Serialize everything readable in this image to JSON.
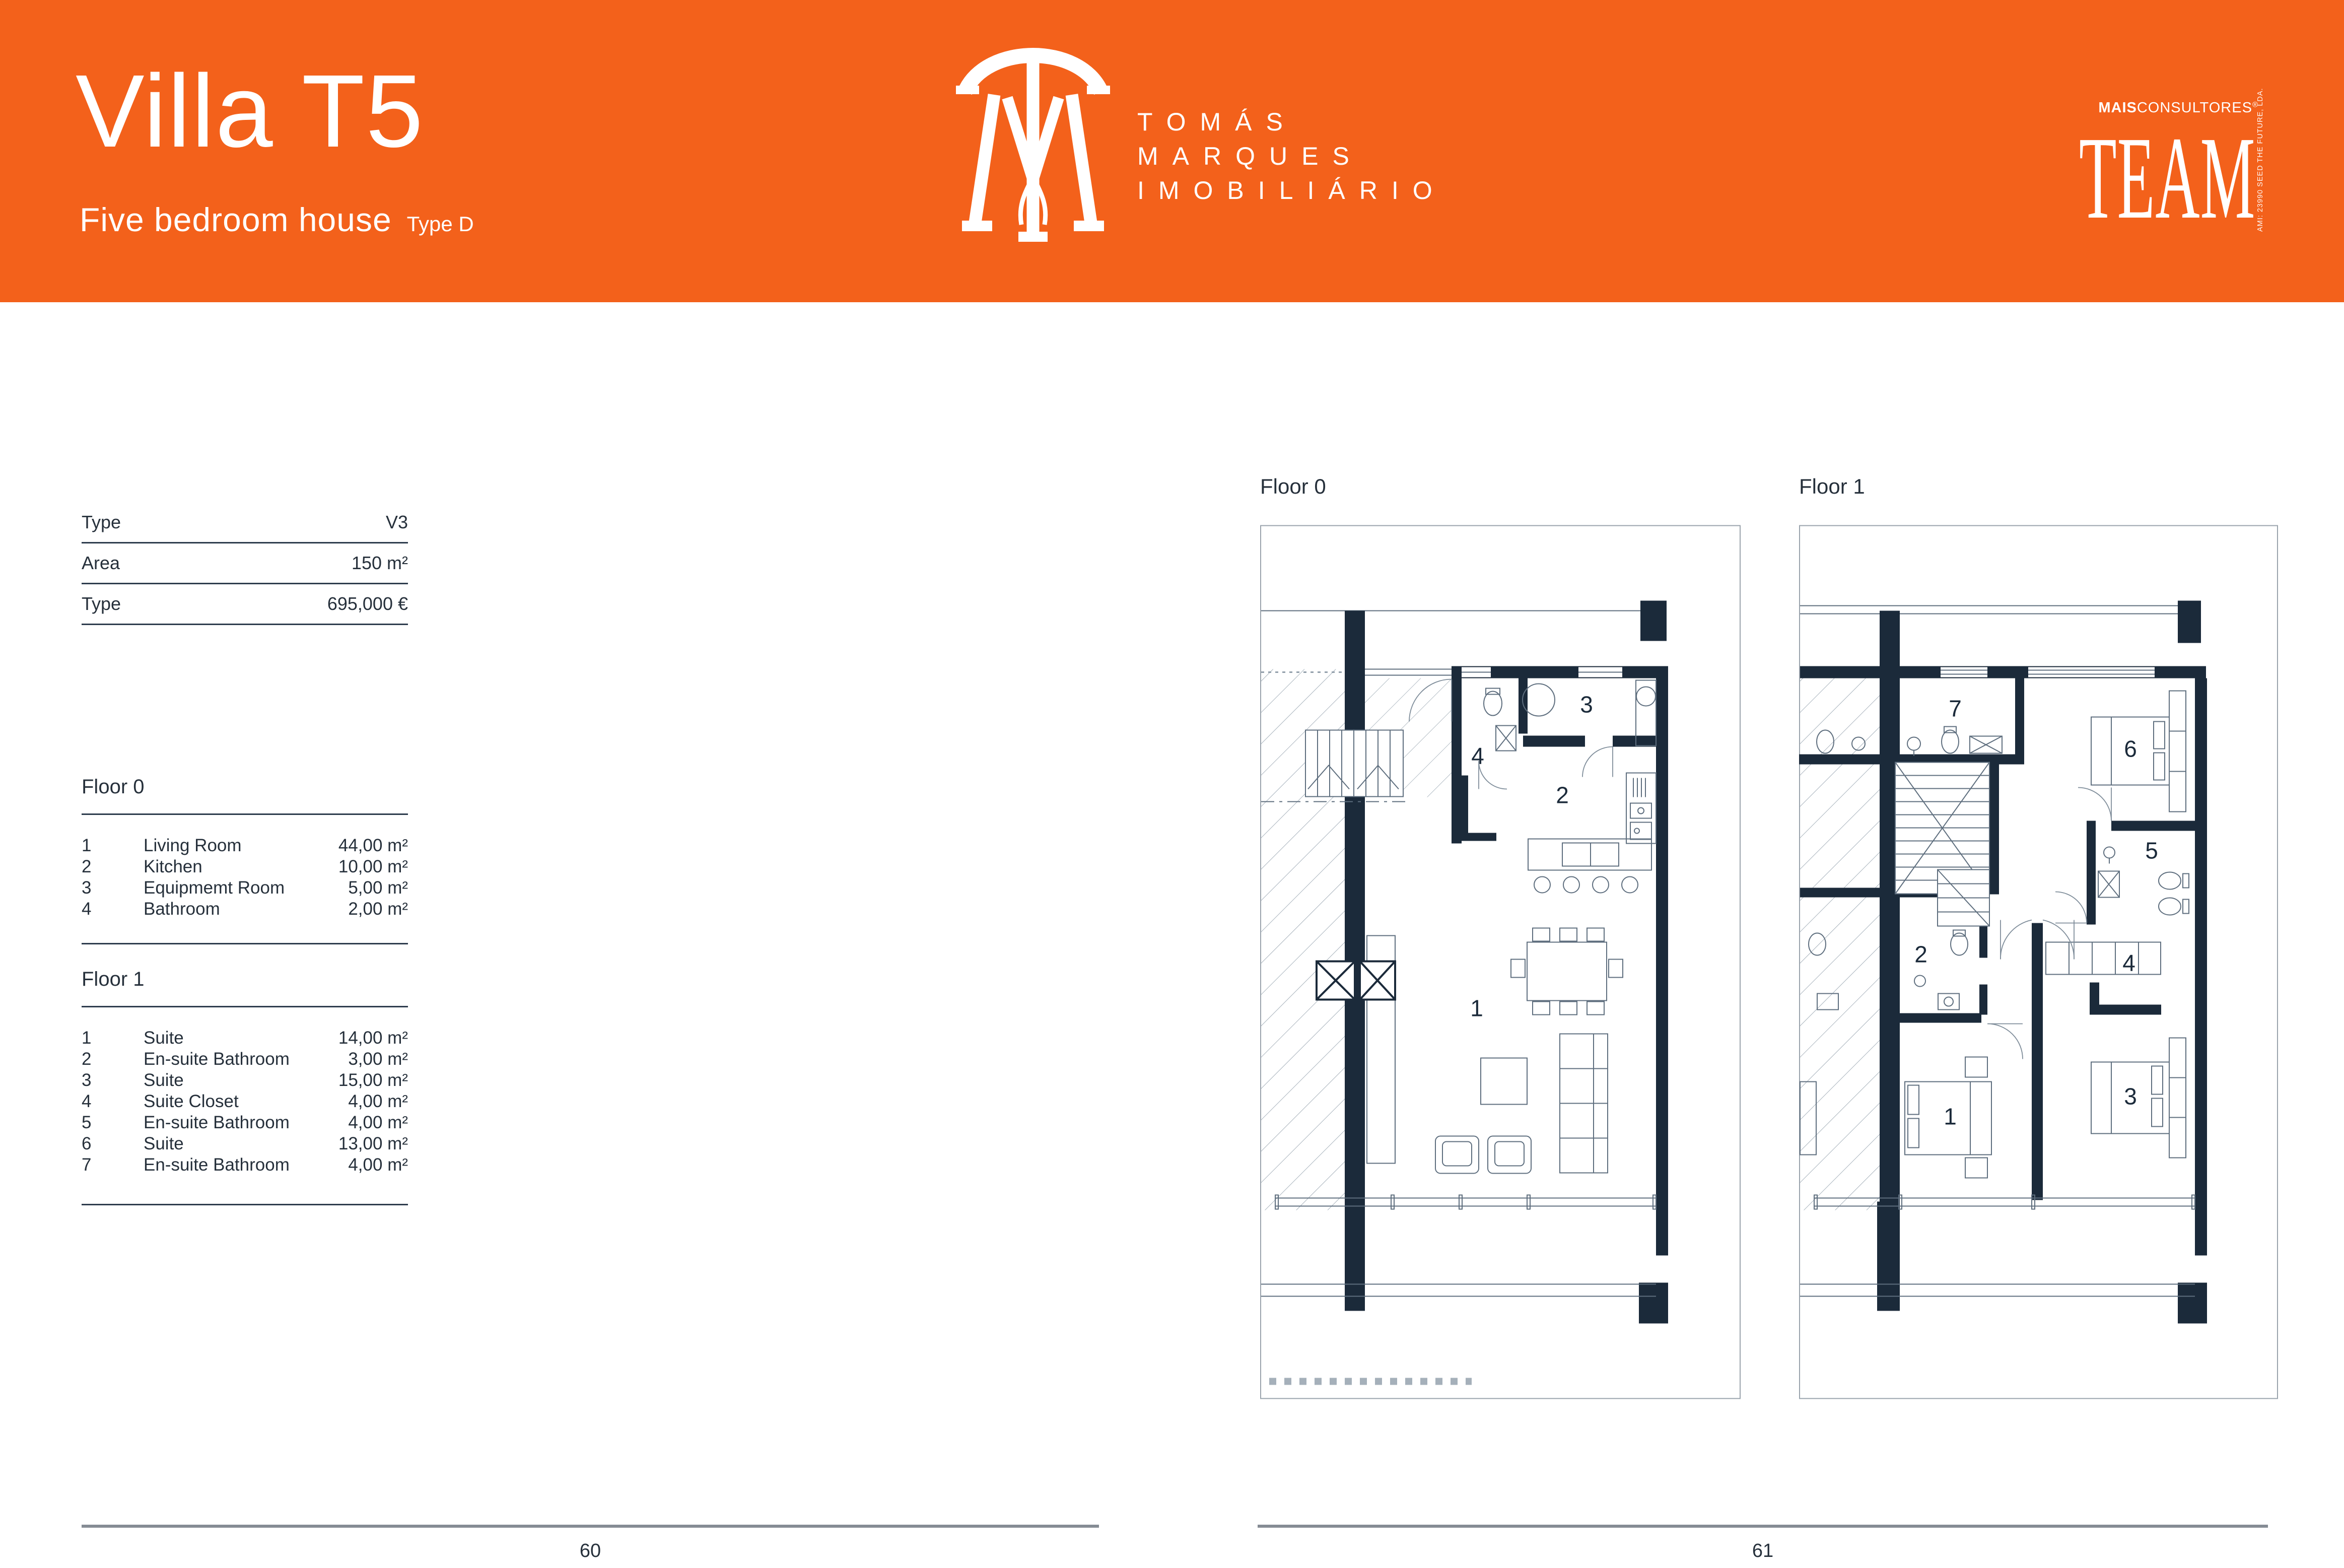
{
  "colors": {
    "accent": "#F3611B",
    "wall": "#1B2A3A",
    "line": "#5E6E7E",
    "table_rule": "#2E3D4E",
    "footer_rule": "#858C94",
    "text": "#26303B"
  },
  "header": {
    "title": "Villa T5",
    "subtitle": "Five bedroom house",
    "type_tag": "Type D",
    "brand_lines": [
      "TOMÁS",
      "MARQUES",
      "IMOBILIÁRIO"
    ],
    "partner": {
      "bold": "MAIS",
      "regular": "CONSULTORES",
      "reg_mark": "®",
      "wordmark": "TEAM",
      "vertical_text": "AMI: 23990  SEED THE FUTURE, LDA."
    }
  },
  "info_table": {
    "rows": [
      {
        "label": "Type",
        "value": "V3"
      },
      {
        "label": "Area",
        "value": "150 m²"
      },
      {
        "label": "Type",
        "value": "695,000 €"
      }
    ]
  },
  "floor_lists": [
    {
      "title": "Floor 0",
      "rooms": [
        {
          "n": "1",
          "name": "Living Room",
          "area": "44,00 m²"
        },
        {
          "n": "2",
          "name": "Kitchen",
          "area": "10,00 m²"
        },
        {
          "n": "3",
          "name": "Equipmemt Room",
          "area": "5,00 m²"
        },
        {
          "n": "4",
          "name": "Bathroom",
          "area": "2,00 m²"
        }
      ]
    },
    {
      "title": "Floor 1",
      "rooms": [
        {
          "n": "1",
          "name": "Suite",
          "area": "14,00 m²"
        },
        {
          "n": "2",
          "name": "En-suite Bathroom",
          "area": "3,00 m²"
        },
        {
          "n": "3",
          "name": "Suite",
          "area": "15,00 m²"
        },
        {
          "n": "4",
          "name": "Suite Closet",
          "area": "4,00 m²"
        },
        {
          "n": "5",
          "name": "En-suite Bathroom",
          "area": "4,00 m²"
        },
        {
          "n": "6",
          "name": "Suite",
          "area": "13,00 m²"
        },
        {
          "n": "7",
          "name": "En-suite Bathroom",
          "area": "4,00 m²"
        }
      ]
    }
  ],
  "plans": [
    {
      "label": "Floor 0",
      "numbers": [
        "1",
        "2",
        "3",
        "4"
      ]
    },
    {
      "label": "Floor 1",
      "numbers": [
        "1",
        "2",
        "3",
        "4",
        "5",
        "6",
        "7"
      ]
    }
  ],
  "footer": {
    "left_page": "60",
    "right_page": "61"
  }
}
